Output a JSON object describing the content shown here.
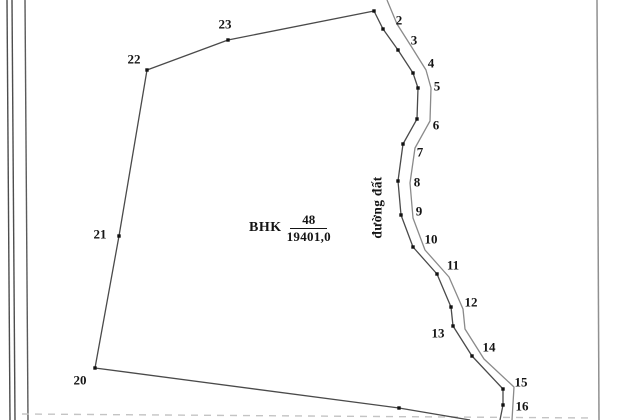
{
  "map": {
    "title": "cadastral parcel sketch",
    "parcel": {
      "code": "BHK",
      "number": "48",
      "area": "19401,0"
    },
    "road": {
      "name": "đường đất"
    },
    "colors": {
      "boundary": "#4a4a4a",
      "road": "#8a8a8a",
      "dot": "#111111",
      "label": "#151515",
      "frame_dark": "#4d4d4d",
      "frame_light": "#909090",
      "dashed": "#c4c4c4"
    },
    "vertices": [
      {
        "n": "2",
        "x": 383,
        "y": 29,
        "lx": 399,
        "ly": 20
      },
      {
        "n": "3",
        "x": 398,
        "y": 50,
        "lx": 414,
        "ly": 40
      },
      {
        "n": "4",
        "x": 413,
        "y": 73,
        "lx": 431,
        "ly": 63
      },
      {
        "n": "5",
        "x": 418,
        "y": 88,
        "lx": 437,
        "ly": 86
      },
      {
        "n": "6",
        "x": 417,
        "y": 119,
        "lx": 436,
        "ly": 125
      },
      {
        "n": "7",
        "x": 403,
        "y": 144,
        "lx": 420,
        "ly": 152
      },
      {
        "n": "8",
        "x": 398,
        "y": 181,
        "lx": 417,
        "ly": 182
      },
      {
        "n": "9",
        "x": 401,
        "y": 215,
        "lx": 419,
        "ly": 211
      },
      {
        "n": "10",
        "x": 413,
        "y": 247,
        "lx": 431,
        "ly": 239
      },
      {
        "n": "11",
        "x": 437,
        "y": 274,
        "lx": 453,
        "ly": 265
      },
      {
        "n": "12",
        "x": 451,
        "y": 307,
        "lx": 471,
        "ly": 302
      },
      {
        "n": "13",
        "x": 453,
        "y": 326,
        "lx": 438,
        "ly": 333
      },
      {
        "n": "14",
        "x": 472,
        "y": 356,
        "lx": 489,
        "ly": 347
      },
      {
        "n": "15",
        "x": 503,
        "y": 389,
        "lx": 521,
        "ly": 382
      },
      {
        "n": "16",
        "x": 503,
        "y": 405,
        "lx": 522,
        "ly": 406
      },
      {
        "n": "20",
        "x": 95,
        "y": 368,
        "lx": 80,
        "ly": 380
      },
      {
        "n": "21",
        "x": 119,
        "y": 236,
        "lx": 100,
        "ly": 234
      },
      {
        "n": "22",
        "x": 147,
        "y": 70,
        "lx": 134,
        "ly": 59
      },
      {
        "n": "23",
        "x": 228,
        "y": 40,
        "lx": 225,
        "ly": 24
      }
    ],
    "extra_dots": [
      [
        374,
        11
      ],
      [
        399,
        408
      ]
    ],
    "boundary_path": [
      [
        500,
        420
      ],
      [
        503,
        405
      ],
      [
        503,
        389
      ],
      [
        472,
        356
      ],
      [
        453,
        326
      ],
      [
        451,
        307
      ],
      [
        437,
        274
      ],
      [
        413,
        247
      ],
      [
        401,
        215
      ],
      [
        398,
        181
      ],
      [
        403,
        144
      ],
      [
        417,
        119
      ],
      [
        418,
        88
      ],
      [
        413,
        73
      ],
      [
        398,
        50
      ],
      [
        383,
        29
      ],
      [
        374,
        11
      ],
      [
        228,
        40
      ],
      [
        147,
        70
      ],
      [
        119,
        236
      ],
      [
        95,
        368
      ],
      [
        399,
        408
      ],
      [
        470,
        420
      ]
    ],
    "road_path": [
      [
        387,
        0
      ],
      [
        397,
        24
      ],
      [
        411,
        46
      ],
      [
        426,
        70
      ],
      [
        431,
        88
      ],
      [
        430,
        121
      ],
      [
        415,
        148
      ],
      [
        410,
        183
      ],
      [
        413,
        218
      ],
      [
        425,
        250
      ],
      [
        449,
        277
      ],
      [
        463,
        309
      ],
      [
        465,
        329
      ],
      [
        484,
        359
      ],
      [
        514,
        387
      ],
      [
        512,
        420
      ]
    ],
    "frame": {
      "lines": [
        [
          7,
          0,
          10,
          420,
          "#4d4d4d",
          1.4,
          "none",
          "sheet-frame-left-outer"
        ],
        [
          12,
          0,
          15,
          420,
          "#4d4d4d",
          1.4,
          "none",
          "sheet-frame-left-inner"
        ],
        [
          25,
          0,
          28,
          420,
          "#5a5a5a",
          1.4,
          "none",
          "sheet-frame-left-margin"
        ],
        [
          597,
          0,
          599,
          420,
          "#909090",
          1.5,
          "none",
          "sheet-frame-right"
        ],
        [
          22,
          414,
          592,
          418,
          "#c4c4c4",
          1.4,
          "7 6",
          "bottom-dashed-line"
        ]
      ]
    }
  }
}
